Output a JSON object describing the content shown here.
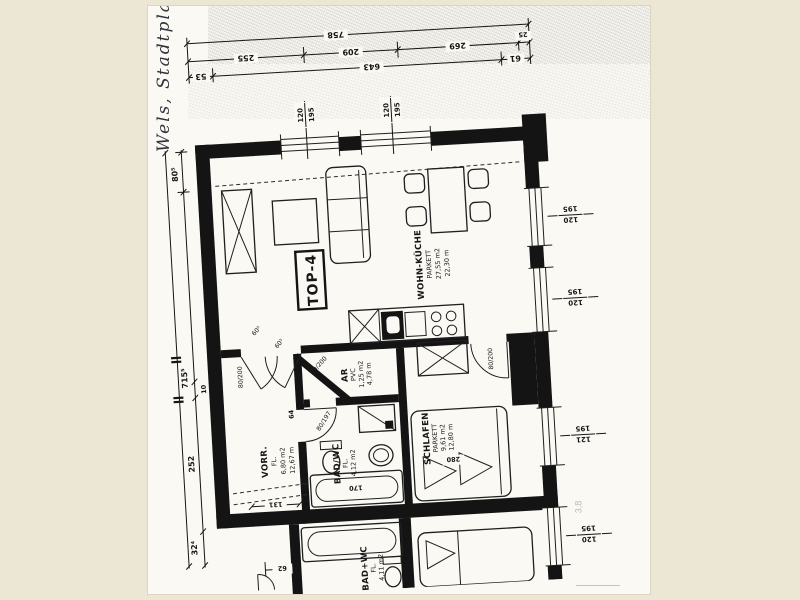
{
  "colors": {
    "ink": "#161616",
    "paper": "#faf9f4",
    "matte": "#ece6d5"
  },
  "page": {
    "handwriting_note": "Wels, Stadtpla",
    "faint_note": "3,8"
  },
  "unit": {
    "label": "TOP-4"
  },
  "rooms": [
    {
      "name": "WOHN-KÜCHE",
      "floor": "PARKETT",
      "area": "27,55 m2",
      "perimeter": "22,30 m"
    },
    {
      "name": "AR",
      "floor": "PVC",
      "area": "1,25 m2",
      "perimeter": "4,78 m"
    },
    {
      "name": "VORR.",
      "floor": "FL.",
      "area": "6,80 m2",
      "perimeter": "12,67 m"
    },
    {
      "name": "BAD/WC",
      "floor": "FL.",
      "area": "4,12 m2"
    },
    {
      "name": "SCHLAFEN",
      "floor": "PARKETT",
      "area": "9,61 m2",
      "perimeter": "12,80 m"
    },
    {
      "name": "BAD+WC",
      "floor": "FL.",
      "area": "4,11 m2"
    }
  ],
  "dims": {
    "top_total": "758",
    "top_row2": [
      "255",
      "209",
      "269",
      "25"
    ],
    "top_row3": [
      "53",
      "643",
      "61"
    ],
    "left": {
      "top": "80⁵",
      "overall": "715⁵",
      "small": "10",
      "mid": "252",
      "bottom": "32⁴"
    },
    "misc": {
      "hall_width": "131",
      "entry": "62",
      "tub": "170",
      "bed": "280",
      "jamb": "64"
    }
  },
  "doors": {
    "vorr": "80/200",
    "ar": "80/200",
    "bedroom": "80/200",
    "bath": "80/197",
    "leaf_a": "60⁵",
    "leaf_b": "60⁵"
  },
  "windows": {
    "top": [
      {
        "w": "120",
        "h": "195"
      },
      {
        "w": "120",
        "h": "195"
      }
    ],
    "right": [
      {
        "w": "120",
        "h": "195"
      },
      {
        "w": "120",
        "h": "195"
      },
      {
        "w": "121",
        "h": "195"
      },
      {
        "w": "120",
        "h": "195"
      }
    ]
  }
}
